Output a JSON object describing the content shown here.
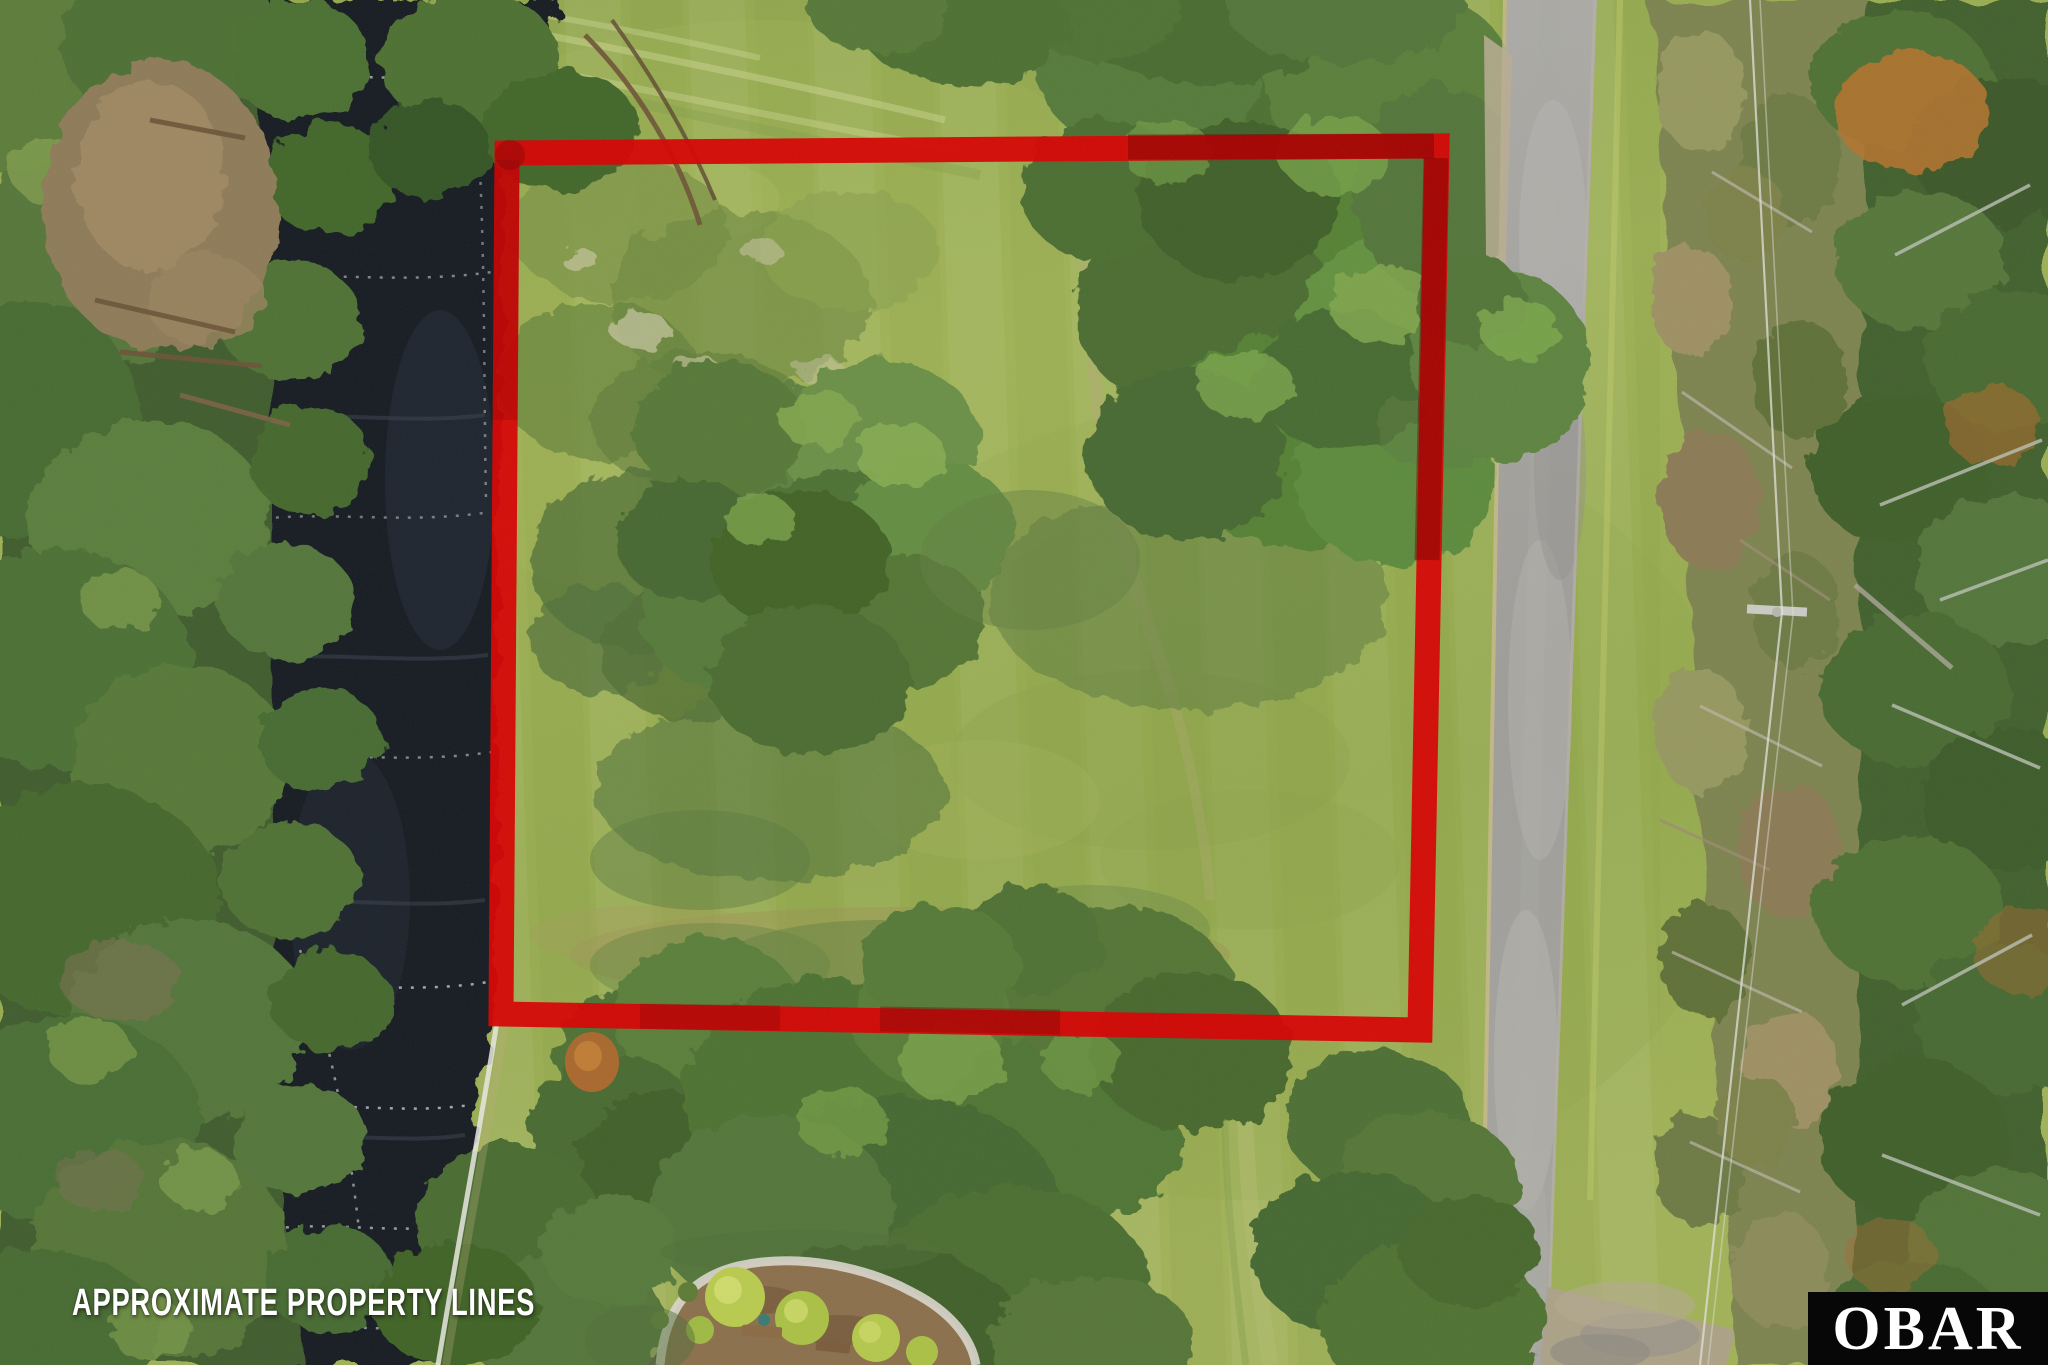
{
  "overlay": {
    "watermark": "APPROXIMATE PROPERTY LINES",
    "brand_logo": "OBAR"
  },
  "boundary": {
    "points": "507,153 1437,146 1420,1030 501,1014",
    "color": "#d50404",
    "stroke_width": 25
  },
  "palette": {
    "boundary_red": "#d50404",
    "boundary_red_dark": "#6f0101",
    "grass_base": "#9aad52",
    "grass_light": "#adbc61",
    "grass_dark": "#7e9747",
    "grass_shadow": "#5e7c3d",
    "tree_dark": "#3f5c2e",
    "tree_mid": "#547538",
    "tree_light": "#79a04a",
    "water": "#171b22",
    "water_glare": "#272e3a",
    "bulkhead": "#e8e6e0",
    "road": "#a3a29e",
    "road_edge_tan": "#c9b98f",
    "scrub": "#7b8350",
    "clearing_dirt": "#8d7a58",
    "mulch": "#8a6f4c",
    "shrub_yellow": "#b7c94f",
    "autumn_tree": "#b5732f",
    "powerline": "#dfe0da",
    "watermark_text": "#ffffff",
    "logo_bg": "#070707",
    "logo_text": "#ffffff"
  }
}
